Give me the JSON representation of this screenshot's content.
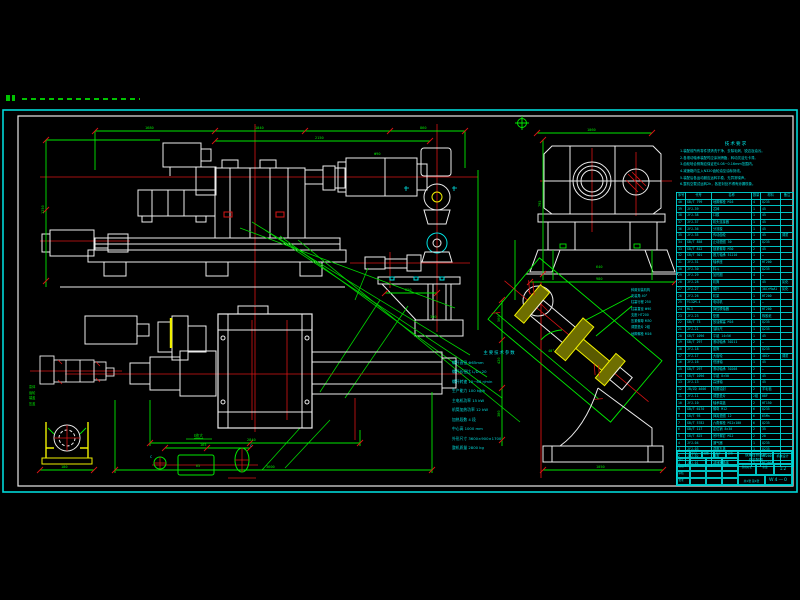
{
  "colors": {
    "white": "#ededed",
    "green": "#00e800",
    "red": "#e41212",
    "yellow": "#f0f000",
    "cyan": "#00e2e2"
  },
  "notes": {
    "title": "技术要求",
    "items": [
      "1.装配前所有零件须清洗干净，去除毛刺、锐边及油污。",
      "2.各滚动轴承装配时应涂润滑脂，转动灵活无卡滞。",
      "3.齿轮啮合侧隙应保证在0.08~0.16mm范围内。",
      "4.减速箱内注入N320齿轮油至油标刻线。",
      "5.装配后各运动副应运转平稳、无异常噪声。",
      "6.整机空载试运转2h，各密封处不得有渗漏现象。"
    ]
  },
  "specs": {
    "title": "主要技术参数",
    "items": [
      "螺杆直径          Φ65mm",
      "螺杆长径比        L/D=20",
      "螺杆转速          10~60 r/min",
      "生产能力          100 kg/h",
      "主电机功率        15 kW",
      "机筒加热功率      12 kW",
      "加热段数          4 段",
      "中心高            1000 mm",
      "外形尺寸          3600×900×1700",
      "整机质量          2800 kg"
    ]
  },
  "callouts": {
    "items": [
      "斜置安装机构",
      "安装角 40°",
      "柱塞行程 250",
      "柱塞直径 Φ90",
      "支座 HT200",
      "压紧螺母 M30",
      "调整垫片 2组",
      "地脚螺栓 M16"
    ]
  },
  "part_labels": {
    "items": [
      "泵体",
      "齿轮",
      "端盖",
      "压盖"
    ]
  },
  "view_labels": {
    "detail": "Ⅰ放大",
    "channel": "65",
    "mark_a": "C",
    "mark_b": "C"
  },
  "dims": [
    "1680",
    "1040",
    "860",
    "2150",
    "1250",
    "1060",
    "795",
    "640",
    "980",
    "2840",
    "3600",
    "180",
    "165",
    "560",
    "420",
    "380",
    "1050",
    "40°",
    "250",
    "Φ90",
    "300"
  ],
  "parts_table": {
    "headers": [
      "序号",
      "代号",
      "名称",
      "数量",
      "材料",
      "备注"
    ],
    "rows": [
      [
        "40",
        "GB/T 799",
        "地脚螺栓 M16",
        "4",
        "Q235",
        ""
      ],
      [
        "39",
        "JYJ-39",
        "芯棒",
        "1",
        "45",
        ""
      ],
      [
        "38",
        "JYJ-38",
        "口模",
        "1",
        "45",
        ""
      ],
      [
        "37",
        "JYJ-37",
        "机头连接器",
        "1",
        "45",
        ""
      ],
      [
        "36",
        "JYJ-36",
        "分流梭",
        "1",
        "45",
        ""
      ],
      [
        "35",
        "JYJ-35",
        "传动齿轮",
        "1",
        "45",
        "调质"
      ],
      [
        "34",
        "GB/T 858",
        "止动垫圈 30",
        "2",
        "Q235",
        ""
      ],
      [
        "33",
        "GB/T 812",
        "锁紧螺母 M30",
        "2",
        "45",
        ""
      ],
      [
        "32",
        "GB/T 301",
        "推力轴承 51210",
        "1",
        "—",
        ""
      ],
      [
        "31",
        "JYJ-31",
        "轴承座",
        "2",
        "HT200",
        ""
      ],
      [
        "30",
        "JYJ-30",
        "料斗",
        "1",
        "Q235",
        ""
      ],
      [
        "29",
        "JYJ-29",
        "加热圈",
        "4",
        "—",
        ""
      ],
      [
        "28",
        "JYJ-28",
        "机筒",
        "1",
        "45",
        "氮化"
      ],
      [
        "27",
        "JYJ-27",
        "螺杆",
        "1",
        "38CrMoAl",
        "氮化"
      ],
      [
        "26",
        "JYJ-26",
        "机架",
        "1",
        "HT200",
        ""
      ],
      [
        "25",
        "Y132M-4",
        "电动机",
        "1",
        "—",
        ""
      ],
      [
        "24",
        "HL3",
        "弹性联轴器",
        "1",
        "HT200",
        ""
      ],
      [
        "23",
        "JYJ-23",
        "垫圈",
        "1",
        "橡胶纸",
        ""
      ],
      [
        "22",
        "GB/T 73",
        "放油螺塞 M16",
        "1",
        "Q235",
        ""
      ],
      [
        "21",
        "JYJ-21",
        "油标尺",
        "1",
        "Q235",
        ""
      ],
      [
        "20",
        "GB/T 1096",
        "平键 14×56",
        "1",
        "45",
        ""
      ],
      [
        "19",
        "GB/T 297",
        "滚动轴承 30211",
        "2",
        "—",
        ""
      ],
      [
        "18",
        "JYJ-18",
        "套筒",
        "1",
        "Q235",
        ""
      ],
      [
        "17",
        "JYJ-17",
        "大齿轮",
        "1",
        "40Cr",
        "调质"
      ],
      [
        "16",
        "JYJ-16",
        "低速轴",
        "1",
        "45",
        ""
      ],
      [
        "15",
        "GB/T 297",
        "滚动轴承 30208",
        "2",
        "—",
        ""
      ],
      [
        "14",
        "GB/T 1096",
        "平键 8×50",
        "1",
        "45",
        ""
      ],
      [
        "13",
        "JYJ-13",
        "高速轴",
        "1",
        "45",
        ""
      ],
      [
        "12",
        "JB/ZQ 4606",
        "毡圈油封",
        "2",
        "羊毛毡",
        ""
      ],
      [
        "11",
        "JYJ-11",
        "调整垫片",
        "2组",
        "08F",
        ""
      ],
      [
        "10",
        "JYJ-10",
        "轴承端盖",
        "2",
        "HT150",
        ""
      ],
      [
        "9",
        "GB/T 6170",
        "螺母 M12",
        "6",
        "Q235",
        ""
      ],
      [
        "8",
        "GB/T 93",
        "弹簧垫圈 12",
        "6",
        "65Mn",
        ""
      ],
      [
        "7",
        "GB/T 5782",
        "六角螺栓 M12×100",
        "6",
        "Q235",
        ""
      ],
      [
        "6",
        "GB/T 117",
        "定位销 8×30",
        "2",
        "35",
        ""
      ],
      [
        "5",
        "GB/T 825",
        "吊环螺钉 M12",
        "2",
        "20",
        ""
      ],
      [
        "4",
        "JYJ-04",
        "通气器",
        "1",
        "Q235",
        ""
      ],
      [
        "3",
        "JYJ-03",
        "观察孔盖",
        "1",
        "Q235",
        ""
      ],
      [
        "2",
        "JYJ-02",
        "箱盖",
        "1",
        "HT200",
        ""
      ],
      [
        "1",
        "JYJ-01",
        "减速器箱体",
        "1",
        "HT200",
        ""
      ]
    ]
  },
  "title_block": {
    "product": "双螺杆挤压机",
    "subtitle": "总装配图",
    "company": "机械设计",
    "stage_label": "阶段标记",
    "weight_label": "重量",
    "scale_label": "比例",
    "scale": "1:2",
    "sheet": "共1张 第1张",
    "drawing_no": "W4—0",
    "sig_header": [
      "",
      "标记",
      "处数",
      "签字",
      "日期"
    ],
    "sig_rows": [
      "设计",
      "校核",
      "审核",
      "批准"
    ]
  }
}
